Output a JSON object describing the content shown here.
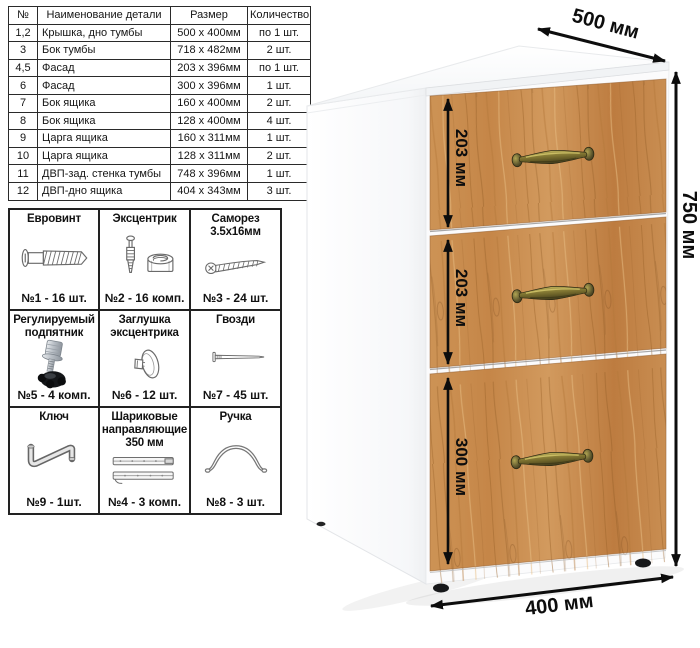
{
  "parts_table": {
    "headers": [
      "№",
      "Наименование детали",
      "Размер",
      "Количество"
    ],
    "rows": [
      {
        "num": "1,2",
        "name": "Крышка, дно тумбы",
        "size": "500 х 400мм",
        "qty": "по 1 шт."
      },
      {
        "num": "3",
        "name": "Бок тумбы",
        "size": "718 х 482мм",
        "qty": "2 шт."
      },
      {
        "num": "4,5",
        "name": "Фасад",
        "size": "203 х 396мм",
        "qty": "по 1 шт."
      },
      {
        "num": "6",
        "name": "Фасад",
        "size": "300 х 396мм",
        "qty": "1 шт."
      },
      {
        "num": "7",
        "name": "Бок ящика",
        "size": "160 х 400мм",
        "qty": "2 шт."
      },
      {
        "num": "8",
        "name": "Бок ящика",
        "size": "128 х 400мм",
        "qty": "4 шт."
      },
      {
        "num": "9",
        "name": "Царга ящика",
        "size": "160 х 311мм",
        "qty": "1 шт."
      },
      {
        "num": "10",
        "name": "Царга ящика",
        "size": "128 х 311мм",
        "qty": "2 шт."
      },
      {
        "num": "11",
        "name": "ДВП-зад. стенка тумбы",
        "size": "748 х 396мм",
        "qty": "1 шт."
      },
      {
        "num": "12",
        "name": "ДВП-дно ящика",
        "size": "404 х 343мм",
        "qty": "3 шт."
      }
    ]
  },
  "hardware": {
    "items": [
      {
        "title": "Евровинт",
        "count": "№1 - 16 шт.",
        "icon": "euro-screw-icon"
      },
      {
        "title": "Эксцентрик",
        "count": "№2 - 16 комп.",
        "icon": "cam-lock-icon"
      },
      {
        "title": "Саморез 3.5х16мм",
        "count": "№3 - 24 шт.",
        "icon": "self-tapping-screw-icon"
      },
      {
        "title": "Регулируемый подпятник",
        "count": "№5 - 4 комп.",
        "icon": "adjustable-foot-icon"
      },
      {
        "title": "Заглушка эксцентрика",
        "count": "№6 - 12 шт.",
        "icon": "cam-cap-icon"
      },
      {
        "title": "Гвозди",
        "count": "№7 - 45 шт.",
        "icon": "nail-icon"
      },
      {
        "title": "Ключ",
        "count": "№9 - 1шт.",
        "icon": "hex-key-icon"
      },
      {
        "title": "Шариковые направляющие 350 мм",
        "count": "№4 - 3 комп.",
        "icon": "drawer-slides-icon"
      },
      {
        "title": "Ручка",
        "count": "№8 - 3 шт.",
        "icon": "handle-icon"
      }
    ]
  },
  "cabinet": {
    "labels": {
      "depth": "500 мм",
      "height": "750 мм",
      "width": "400 мм",
      "drawer_top": "203 мм",
      "drawer_middle": "203 мм",
      "drawer_bottom": "300 мм"
    },
    "colors": {
      "wood_base": "#c68a4c",
      "wood_dark": "#9c6126",
      "wood_light": "#e7bd83",
      "handle_brass": "#8d8138",
      "arrow": "#0d0d0d",
      "panel_white": "#fbfbfc"
    }
  }
}
